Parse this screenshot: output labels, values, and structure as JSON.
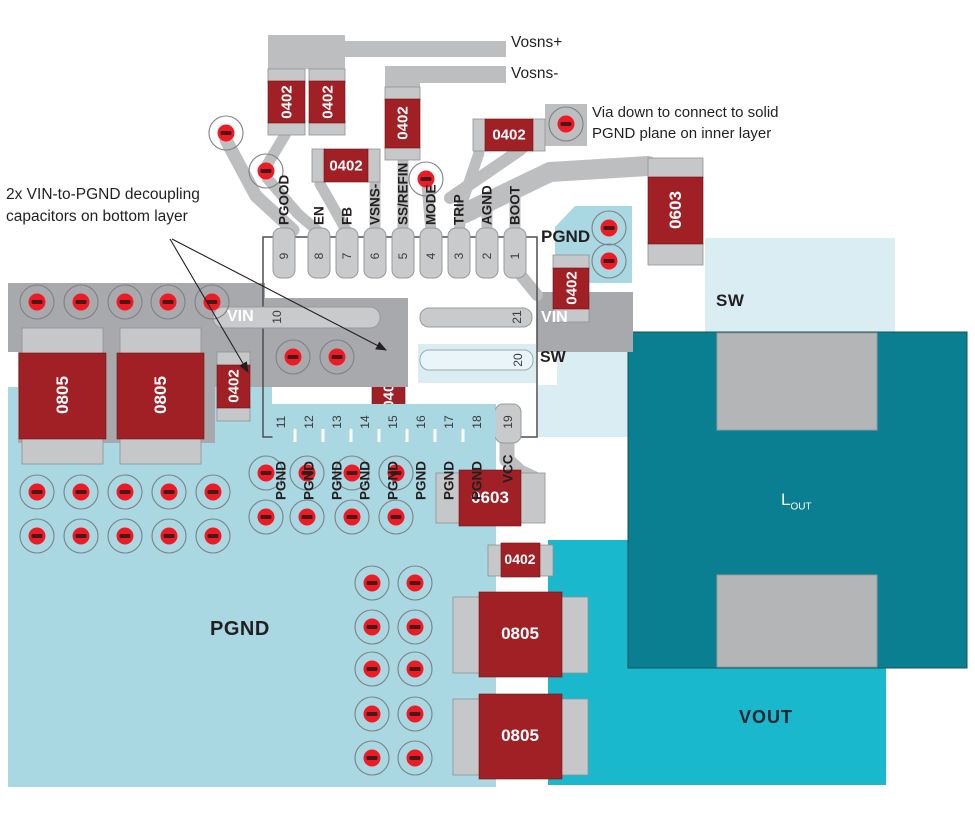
{
  "notes": {
    "decoupling_line1": "2x VIN-to-PGND decoupling",
    "decoupling_line2": "capacitors on bottom layer",
    "via_line1": "Via down to connect to solid",
    "via_line2": "PGND plane on inner layer"
  },
  "signals": {
    "vosns_plus": "Vosns+",
    "vosns_minus": "Vosns-"
  },
  "chip": {
    "top_pins": [
      {
        "num": "9",
        "label": "PGOOD"
      },
      {
        "num": "8",
        "label": "EN"
      },
      {
        "num": "7",
        "label": "FB"
      },
      {
        "num": "6",
        "label": "VSNS-"
      },
      {
        "num": "5",
        "label": "SS/REFIN"
      },
      {
        "num": "4",
        "label": "MODE"
      },
      {
        "num": "3",
        "label": "TRIP"
      },
      {
        "num": "2",
        "label": "AGND"
      },
      {
        "num": "1",
        "label": "BOOT"
      }
    ],
    "left_pin": {
      "num": "10",
      "label": "VIN"
    },
    "right_pins": [
      {
        "num": "21",
        "label": "VIN"
      },
      {
        "num": "20",
        "label": "SW"
      }
    ],
    "bottom_pins": [
      {
        "num": "11",
        "label": "PGND"
      },
      {
        "num": "12",
        "label": "PGND"
      },
      {
        "num": "13",
        "label": "PGND"
      },
      {
        "num": "14",
        "label": "PGND"
      },
      {
        "num": "15",
        "label": "PGND"
      },
      {
        "num": "16",
        "label": "PGND"
      },
      {
        "num": "17",
        "label": "PGND"
      },
      {
        "num": "18",
        "label": "PGND"
      }
    ],
    "vcc_pin": {
      "num": "19",
      "label": "VCC"
    }
  },
  "regions": {
    "pgnd_top": "PGND",
    "pgnd_main": "PGND",
    "vin_left": "VIN",
    "vin_right": "VIN",
    "sw_small": "SW",
    "sw_large": "SW",
    "vout": "VOUT",
    "inductor_main": "L",
    "inductor_sub": "OUT"
  },
  "components": [
    {
      "label": "0402"
    },
    {
      "label": "0402"
    },
    {
      "label": "0402"
    },
    {
      "label": "0402"
    },
    {
      "label": "0402"
    },
    {
      "label": "0402"
    },
    {
      "label": "0603"
    },
    {
      "label": "0402"
    },
    {
      "label": "0402"
    },
    {
      "label": "0603"
    },
    {
      "label": "0402"
    },
    {
      "label": "0805"
    },
    {
      "label": "0805"
    },
    {
      "label": "0805"
    },
    {
      "label": "0805"
    }
  ],
  "colors": {
    "copper_red": "#a02025",
    "via_red": "#ee1b24",
    "plane_blue": "#a9d7e2",
    "pale_blue": "#daedf3",
    "teal": "#097f91",
    "cyan": "#19b8cc",
    "slab_gray": "#a7a9ac",
    "trace_gray": "#bcbec0",
    "pad_gray": "#c6c7c9"
  }
}
